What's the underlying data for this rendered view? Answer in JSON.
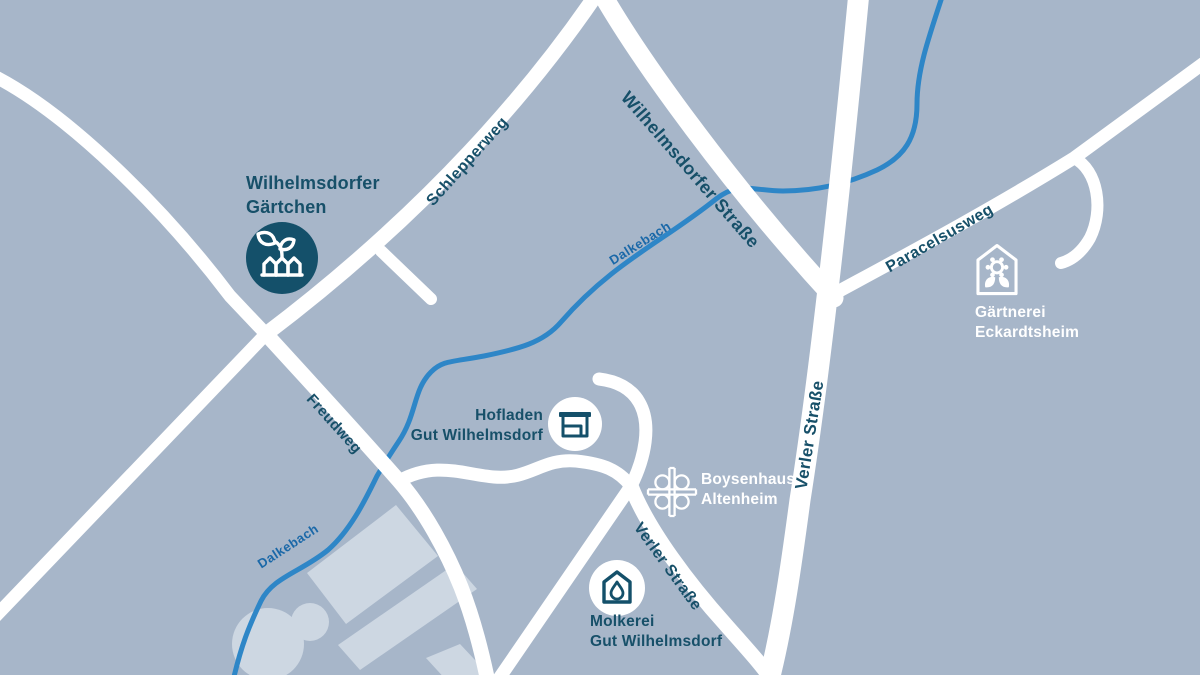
{
  "map": {
    "colors": {
      "background": "#a7b6c9",
      "road": "#ffffff",
      "river": "#2e86c7",
      "label_dark": "#175069",
      "river_label": "#1a68a8",
      "poi_disc_dark": "#14506a",
      "poi_disc_white": "#ffffff",
      "building_shape": "#cdd7e2"
    },
    "streets": [
      {
        "label": "Schlepperweg"
      },
      {
        "label": "Wilhelmsdorfer Straße"
      },
      {
        "label": "Paracelsusweg"
      },
      {
        "label": "Verler Straße"
      },
      {
        "label": "Verler Straße"
      },
      {
        "label": "Freudweg"
      }
    ],
    "river": {
      "label": "Dalkebach"
    },
    "pois": [
      {
        "id": "wilhelmsdorfer-gaertchen",
        "line1": "Wilhelmsdorfer",
        "line2": "Gärtchen",
        "icon": "sprout-garden-bed-icon"
      },
      {
        "id": "gaertnerei-eckardtsheim",
        "line1": "Gärtnerei",
        "line2": "Eckardtsheim",
        "icon": "greenhouse-flower-icon"
      },
      {
        "id": "hofladen-gut-wilhelmsdorf",
        "line1": "Hofladen",
        "line2": "Gut Wilhelmsdorf",
        "icon": "market-stall-icon"
      },
      {
        "id": "boysenhaus-altenheim",
        "line1": "Boysenhaus",
        "line2": "Altenheim",
        "icon": "bethel-cross-icon"
      },
      {
        "id": "molkerei-gut-wilhelmsdorf",
        "line1": "Molkerei",
        "line2": "Gut Wilhelmsdorf",
        "icon": "house-drop-icon"
      }
    ]
  }
}
